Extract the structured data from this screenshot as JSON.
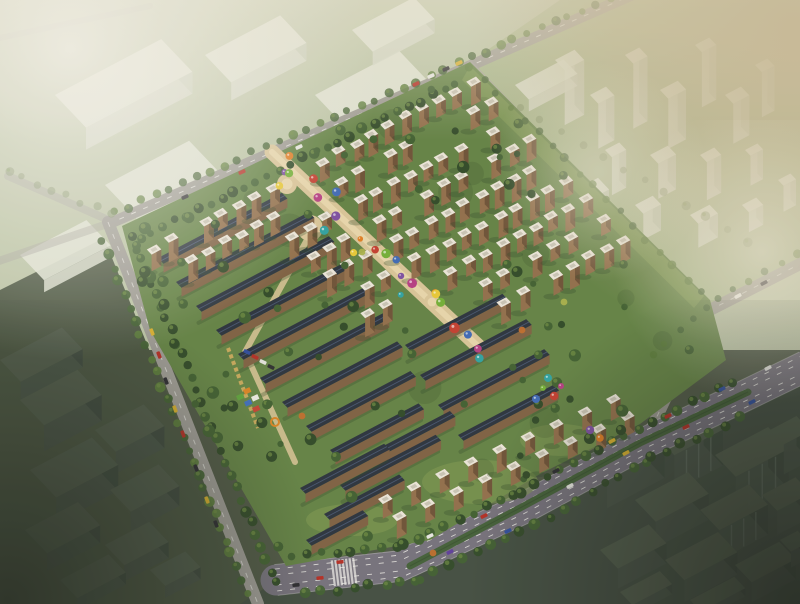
{
  "meta": {
    "description": "aerial-architectural-rendering-of-residential-complex",
    "width": 800,
    "height": 604
  },
  "palette": {
    "field_top": "#bac4a5",
    "lawn_tr": "#a6b68b",
    "ground_bottom": "#4a5442",
    "dark_bl": "#45513d",
    "dark_br": "#3e4a3e",
    "site_green": "#5f7f41",
    "site_green_light": "#7b984e",
    "tree_dark": "#2b4523",
    "tree_mid": "#3c5c2d",
    "tree_light": "#557736",
    "tree_faded": "#77895e",
    "road": "#9b9993",
    "road_minor": "#a4a29c",
    "boulevard": "#726e7a",
    "median": "#3e5c34",
    "lane_white": "#f2f2ee",
    "promenade": "#d9c497",
    "promenade_light": "#ead9ae",
    "tower_front": "#8f6b47",
    "tower_side": "#6a4e33",
    "roof_white": "#ebe6da",
    "roof_cap": "#c6c1b2",
    "slab_roof": "#252e3a",
    "slab_ridge": "#44536e",
    "slab_front": "#7b5d3f",
    "ghost_top": "#e2e6d7",
    "ghost_side": "#c5ccb8",
    "ghost_front": "#d4d9c9",
    "dark_top": "#4d5948",
    "dark_side": "#39453a",
    "dark_front": "#434f43",
    "dark_stripe": "#5d6a5e",
    "haze_white": "#f4f2ea",
    "haze_beige": "#c8b996",
    "vignette_dark": "#1c231b",
    "car_red": "#b22820",
    "car_white": "#e8e8e4",
    "car_dark": "#26262c",
    "car_yellow": "#d8ae28",
    "car_blue": "#2a4a9e",
    "car_purple": "#5a3a9a",
    "car_orange": "#cc6a20",
    "kid_green": "#5a9e3a",
    "kid_blue": "#3a6ab8",
    "kid_red": "#c04030",
    "kid_orange": "#d88020",
    "kid_white": "#e8e8e0",
    "pergola": "#c8a85a",
    "accent_orange": "#c06a28",
    "accent_yellow": "#a8b048"
  },
  "scene": {
    "site_outline": [
      [
        122,
        226
      ],
      [
        470,
        62
      ],
      [
        710,
        300
      ],
      [
        726,
        360
      ],
      [
        640,
        424
      ],
      [
        540,
        474
      ],
      [
        430,
        540
      ],
      [
        286,
        566
      ],
      [
        150,
        330
      ]
    ],
    "ne_lawn_strip": [
      [
        470,
        66
      ],
      [
        704,
        296
      ],
      [
        694,
        308
      ],
      [
        462,
        80
      ]
    ],
    "south_lawns": [
      [
        480,
        482,
        58,
        22
      ],
      [
        352,
        520,
        46,
        16
      ],
      [
        560,
        440,
        40,
        16
      ]
    ],
    "roads": {
      "nw": {
        "pts": [
          [
            648,
            -12
          ],
          [
            113,
            222
          ]
        ],
        "w": 11
      },
      "sw": {
        "pts": [
          [
            108,
            222
          ],
          [
            258,
            604
          ]
        ],
        "w": 12
      },
      "ne_boundary": {
        "pts": [
          [
            470,
            64
          ],
          [
            706,
            310
          ]
        ],
        "w": 7
      },
      "east": {
        "pts": [
          [
            646,
            440
          ],
          [
            706,
            312
          ],
          [
            800,
            264
          ]
        ],
        "w": 12
      },
      "boulevard": {
        "pts": [
          [
            276,
            580
          ],
          [
            400,
            566
          ],
          [
            520,
            510
          ],
          [
            640,
            445
          ],
          [
            740,
            398
          ],
          [
            806,
            366
          ]
        ],
        "w": 31
      },
      "median_pts": [
        [
          410,
          566
        ],
        [
          520,
          508
        ],
        [
          640,
          443
        ],
        [
          748,
          392
        ]
      ],
      "faint": [
        {
          "pts": [
            [
              113,
              222
            ],
            [
              8,
              176
            ]
          ],
          "w": 8,
          "op": 0.55
        },
        {
          "pts": [
            [
              113,
              222
            ],
            [
              -4,
              262
            ]
          ],
          "w": 8,
          "op": 0.5
        },
        {
          "pts": [
            [
              0,
              38
            ],
            [
              150,
              6
            ]
          ],
          "w": 6,
          "op": 0.35
        }
      ]
    },
    "crosswalk": {
      "center": [
        344,
        572
      ],
      "dir": [
        0.99,
        -0.12
      ],
      "stripes": 7
    },
    "promenade": {
      "a": [
        272,
        152
      ],
      "b": [
        478,
        346
      ],
      "width": 15,
      "plazas": [
        [
          310,
          228,
          13
        ],
        [
          287,
          184,
          10
        ],
        [
          432,
          302,
          8
        ]
      ],
      "west_path": [
        [
          308,
          238
        ],
        [
          245,
          352
        ],
        [
          295,
          462
        ]
      ],
      "pergola": [
        [
          228,
          348
        ],
        [
          258,
          428
        ]
      ],
      "kindergarten": [
        [
          236,
          396,
          "kid_green"
        ],
        [
          244,
          402,
          "kid_blue"
        ],
        [
          252,
          408,
          "kid_red"
        ],
        [
          243,
          390,
          "kid_orange"
        ],
        [
          251,
          397,
          "kid_white"
        ]
      ],
      "play_ring": [
        275,
        422,
        4
      ]
    },
    "towers": {
      "origin": [
        148,
        248
      ],
      "du": 18.8,
      "dv": 27.2,
      "cols": 20,
      "rows": 9,
      "skip_rules": "west-slab-zone v>=2&u<6; south-zone v>=7&u<12; promenade corridor; outside site",
      "se_rows": [
        {
          "start": [
            392,
            516
          ],
          "end": [
            620,
            416
          ],
          "n": 9
        },
        {
          "start": [
            378,
            499
          ],
          "end": [
            606,
            399
          ],
          "n": 9
        }
      ]
    },
    "slabs": {
      "west": [
        [
          158,
          258,
          140
        ],
        [
          176,
          282,
          150
        ],
        [
          196,
          306,
          150
        ],
        [
          216,
          330,
          150
        ],
        [
          238,
          354,
          145
        ],
        [
          260,
          378,
          140
        ],
        [
          282,
          402,
          130
        ],
        [
          306,
          426,
          118
        ],
        [
          330,
          450,
          100
        ]
      ],
      "south": [
        [
          405,
          345,
          110
        ],
        [
          420,
          375,
          120
        ],
        [
          438,
          405,
          120
        ],
        [
          458,
          435,
          108
        ],
        [
          372,
          452,
          88
        ],
        [
          340,
          485,
          108
        ],
        [
          300,
          488,
          95
        ],
        [
          324,
          514,
          85
        ],
        [
          306,
          540,
          64
        ]
      ]
    },
    "balloons": {
      "spine": {
        "a": [
          278,
          158
        ],
        "b": [
          476,
          344
        ],
        "count": 24,
        "jitter": 16
      },
      "cluster": [
        [
          543,
          388
        ],
        [
          554,
          396
        ],
        [
          536,
          399
        ],
        [
          561,
          386
        ],
        [
          548,
          378
        ],
        [
          590,
          430
        ],
        [
          600,
          438
        ]
      ],
      "colors": [
        "#7a4ba0",
        "#e07a1e",
        "#e8c832",
        "#6fae32",
        "#c23a2c",
        "#3a66b4",
        "#b43a80",
        "#2aa0a0"
      ]
    },
    "cars": [
      [
        185,
        197,
        -24,
        "car_dark"
      ],
      [
        242,
        172,
        -24,
        "car_red"
      ],
      [
        299,
        147,
        -24,
        "car_white"
      ],
      [
        416,
        84,
        -24,
        "car_red"
      ],
      [
        431,
        76,
        -24,
        "car_white"
      ],
      [
        446,
        69,
        -24,
        "car_dark"
      ],
      [
        459,
        63,
        -24,
        "car_yellow"
      ],
      [
        152,
        332,
        69,
        "car_yellow"
      ],
      [
        159,
        355,
        69,
        "car_red"
      ],
      [
        166,
        381,
        69,
        "car_dark"
      ],
      [
        175,
        409,
        69,
        "car_yellow"
      ],
      [
        183,
        434,
        69,
        "car_red"
      ],
      [
        196,
        468,
        69,
        "car_dark"
      ],
      [
        207,
        500,
        69,
        "car_yellow"
      ],
      [
        216,
        524,
        69,
        "car_dark"
      ],
      [
        340,
        562,
        -6,
        "car_red"
      ],
      [
        430,
        536,
        -25,
        "car_white"
      ],
      [
        484,
        516,
        -25,
        "car_red"
      ],
      [
        556,
        471,
        -28,
        "car_dark"
      ],
      [
        612,
        441,
        -28,
        "car_yellow"
      ],
      [
        668,
        416,
        -25,
        "car_red"
      ],
      [
        722,
        389,
        -25,
        "car_blue"
      ],
      [
        768,
        368,
        -27,
        "car_white"
      ],
      [
        296,
        585,
        -4,
        "car_dark"
      ],
      [
        320,
        578,
        -6,
        "car_red"
      ],
      [
        450,
        552,
        -25,
        "car_purple"
      ],
      [
        508,
        531,
        -25,
        "car_blue"
      ],
      [
        570,
        486,
        -28,
        "car_white"
      ],
      [
        626,
        453,
        -28,
        "car_yellow"
      ],
      [
        686,
        427,
        -25,
        "car_red"
      ],
      [
        752,
        402,
        -27,
        "car_blue"
      ],
      [
        738,
        296,
        -28,
        "car_white"
      ],
      [
        764,
        283,
        -28,
        "car_dark"
      ]
    ],
    "parked_cars": [
      [
        247,
        352,
        25,
        "car_blue"
      ],
      [
        255,
        357,
        25,
        "car_red"
      ],
      [
        263,
        362,
        25,
        "car_white"
      ],
      [
        271,
        367,
        25,
        "car_dark"
      ]
    ],
    "ghost_tl": [
      [
        55,
        95,
        120,
        45,
        22
      ],
      [
        205,
        55,
        85,
        38,
        18
      ],
      [
        315,
        95,
        95,
        40,
        20
      ],
      [
        105,
        185,
        95,
        45,
        20
      ],
      [
        250,
        175,
        105,
        48,
        22
      ],
      [
        352,
        30,
        70,
        30,
        14
      ],
      [
        20,
        255,
        75,
        35,
        12
      ]
    ],
    "ghost_tr": [
      [
        555,
        60,
        22,
        14,
        55
      ],
      [
        590,
        95,
        18,
        12,
        45
      ],
      [
        625,
        55,
        16,
        12,
        65
      ],
      [
        660,
        90,
        20,
        12,
        50
      ],
      [
        695,
        45,
        16,
        10,
        55
      ],
      [
        725,
        95,
        18,
        12,
        40
      ],
      [
        755,
        65,
        14,
        10,
        45
      ],
      [
        605,
        150,
        16,
        10,
        38
      ],
      [
        650,
        155,
        20,
        12,
        35
      ],
      [
        700,
        155,
        16,
        10,
        38
      ],
      [
        745,
        150,
        14,
        8,
        30
      ],
      [
        575,
        190,
        26,
        16,
        20
      ],
      [
        635,
        205,
        20,
        12,
        26
      ],
      [
        690,
        215,
        22,
        12,
        24
      ],
      [
        742,
        205,
        16,
        10,
        20
      ],
      [
        515,
        85,
        55,
        20,
        12
      ],
      [
        778,
        180,
        14,
        8,
        26
      ]
    ],
    "ghost_bl": [
      [
        0,
        360,
        70,
        30,
        18
      ],
      [
        20,
        400,
        65,
        35,
        26
      ],
      [
        95,
        430,
        55,
        30,
        22
      ],
      [
        30,
        470,
        70,
        38,
        26
      ],
      [
        110,
        490,
        55,
        30,
        20
      ],
      [
        25,
        530,
        60,
        32,
        18
      ],
      [
        105,
        545,
        50,
        28,
        16
      ],
      [
        60,
        580,
        55,
        25,
        12
      ],
      [
        150,
        570,
        40,
        22,
        12
      ]
    ],
    "ghost_br": [
      [
        585,
        455,
        65,
        32,
        30
      ],
      [
        655,
        435,
        55,
        28,
        36
      ],
      [
        715,
        455,
        60,
        30,
        40
      ],
      [
        770,
        430,
        30,
        20,
        30
      ],
      [
        635,
        500,
        60,
        30,
        26
      ],
      [
        700,
        510,
        55,
        28,
        30
      ],
      [
        762,
        495,
        38,
        22,
        24
      ],
      [
        600,
        550,
        55,
        26,
        20
      ],
      [
        665,
        560,
        60,
        28,
        22
      ],
      [
        735,
        565,
        50,
        24,
        20
      ],
      [
        780,
        540,
        20,
        16,
        16
      ],
      [
        620,
        592,
        45,
        18,
        10
      ],
      [
        690,
        600,
        50,
        16,
        8
      ]
    ],
    "ghost_br_striped": [
      1,
      2,
      5
    ],
    "tree_lines": [
      {
        "pts": [
          [
            640,
            -6
          ],
          [
            116,
            221
          ]
        ],
        "off": [
          -3,
          -8
        ],
        "spacing": 15,
        "r": [
          3.2,
          5.0
        ],
        "op": 0.85,
        "tone": "mid"
      },
      {
        "pts": [
          [
            140,
            238
          ],
          [
            460,
            82
          ]
        ],
        "off": [
          0,
          0
        ],
        "spacing": 13,
        "r": [
          3.4,
          5.6
        ],
        "op": 1,
        "tone": "dark"
      },
      {
        "pts": [
          [
            112,
            240
          ],
          [
            258,
            595
          ]
        ],
        "off": [
          -9,
          3
        ],
        "spacing": 14,
        "r": [
          3.4,
          5.4
        ],
        "op": 0.95,
        "tone": "mid"
      },
      {
        "pts": [
          [
            122,
            238
          ],
          [
            268,
            588
          ]
        ],
        "off": [
          9,
          -3
        ],
        "spacing": 13,
        "r": [
          3.6,
          5.8
        ],
        "op": 1,
        "tone": "dark"
      },
      {
        "pts": [
          [
            292,
            556
          ],
          [
            404,
            545
          ],
          [
            520,
            492
          ],
          [
            638,
            428
          ],
          [
            736,
            382
          ]
        ],
        "off": [
          0,
          0
        ],
        "spacing": 15,
        "r": [
          3.6,
          5.6
        ],
        "op": 1,
        "tone": "dark"
      },
      {
        "pts": [
          [
            306,
            594
          ],
          [
            420,
            580
          ],
          [
            536,
            524
          ],
          [
            652,
            458
          ],
          [
            752,
            412
          ]
        ],
        "off": [
          0,
          0
        ],
        "spacing": 16,
        "r": [
          3.8,
          5.8
        ],
        "op": 0.95,
        "tone": "dark"
      },
      {
        "pts": [
          [
            470,
            66
          ],
          [
            704,
            296
          ]
        ],
        "off": [
          0,
          0
        ],
        "spacing": 19,
        "r": [
          3,
          4.6
        ],
        "op": 0.8,
        "tone": "mid"
      },
      {
        "pts": [
          [
            800,
            262
          ],
          [
            710,
            314
          ],
          [
            650,
            368
          ]
        ],
        "off": [
          -4,
          -8
        ],
        "spacing": 18,
        "r": [
          3,
          4.6
        ],
        "op": 0.75,
        "tone": "mid"
      },
      {
        "pts": [
          [
            520,
            108
          ],
          [
            760,
            248
          ]
        ],
        "off": [
          0,
          0
        ],
        "spacing": 24,
        "r": [
          3,
          5
        ],
        "op": 0.5,
        "tone": "faded"
      },
      {
        "pts": [
          [
            8,
            178
          ],
          [
            113,
            222
          ]
        ],
        "off": [
          0,
          -7
        ],
        "spacing": 16,
        "r": [
          3,
          4.5
        ],
        "op": 0.55,
        "tone": "faded"
      }
    ],
    "interior_trees": {
      "count": 72,
      "min_promenade_dist": 16
    },
    "west_park_trees": {
      "box": [
        128,
        252,
        118,
        215
      ],
      "count": 15
    },
    "accent_trees": [
      [
        433,
        553,
        "accent_orange"
      ],
      [
        302,
        416,
        "accent_orange"
      ],
      [
        522,
        330,
        "accent_orange"
      ],
      [
        564,
        302,
        "accent_yellow"
      ],
      [
        362,
        252,
        "accent_yellow"
      ]
    ],
    "mottling_count": 22
  }
}
